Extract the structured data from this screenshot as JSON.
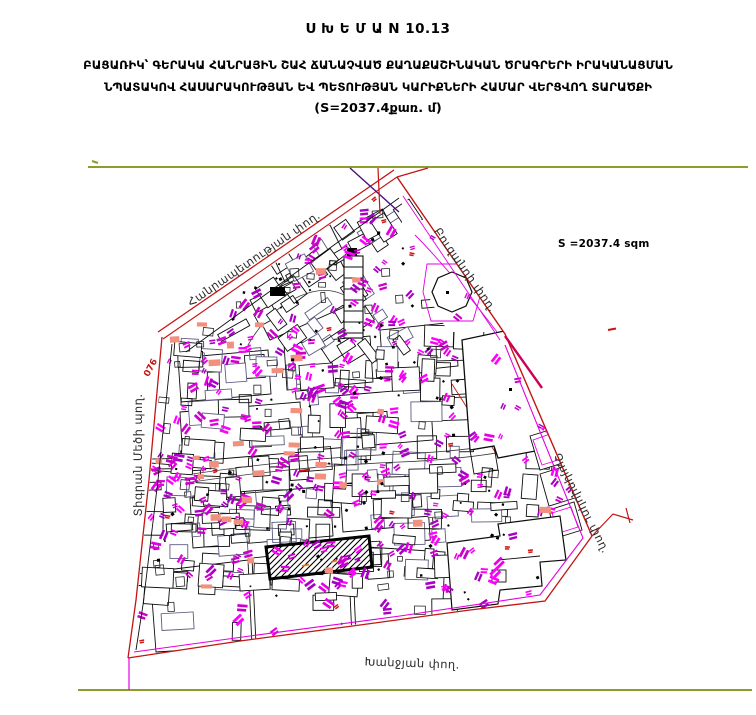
{
  "header": {
    "title": "Ս Խ Ե Մ Ա N 10.13",
    "line1": "ԲԱՑԱՌԻԿ՝ ԳԵՐԱԿԱ ՀԱՆՐԱՅԻՆ ՇԱՀ ՃԱՆԱՉՎԱԾ ՔԱՂԱՔԱՇԻՆԱԿԱՆ ԾՐԱԳՐԵՐԻ ԻՐԱԿԱՆԱՑՄԱՆ",
    "line2": "ՆՊԱՏԱԿՈՎ ՀԱՍԱՐԱԿՈՒԹՅԱՆ ԵՎ ՊԵՏՈՒԹՅԱՆ ԿԱՐԻՔՆԵՐԻ ՀԱՄԱՐ ՎԵՐՑՎՈՂ ՏԱՐԱԾՔԻ",
    "line3": "(S=2037.4քառ. մ)"
  },
  "map": {
    "area_label": "S =2037.4 sqm",
    "taken_area_sqm": 2037.4,
    "left_boundary_marker": "076",
    "streets": {
      "hanrapetutyan": "Հանրապետության փող.",
      "buzand": "Բուզանդի փող.",
      "tigran_mets": "Տիգրան Մեծի պող.",
      "tchaikovsky": "Չայկովսկու փող.",
      "khanjyan": "Խանջյան փող."
    },
    "colors": {
      "street_red": "#c41414",
      "street_magenta": "#e400e4",
      "frame_olive": "#8e9c2c",
      "dark_violet": "#4a1080",
      "crimson": "#cc0055"
    },
    "texture": {
      "seed": 137,
      "counts": {
        "parcels": 240,
        "sheds": 60,
        "marks": 295,
        "salmon": 32,
        "dots": 100,
        "red_marks": 12
      },
      "palette": {
        "magenta": [
          "#cc00cc",
          "#e400e4",
          "#ff00ff",
          "#a800c4"
        ],
        "salmon": "#f2907f",
        "orange": "#e07a1e",
        "dot": "#000000",
        "red": "#cc1515",
        "parcel_strokes": [
          "#0d0d0d",
          "#5c5c80"
        ]
      }
    }
  }
}
